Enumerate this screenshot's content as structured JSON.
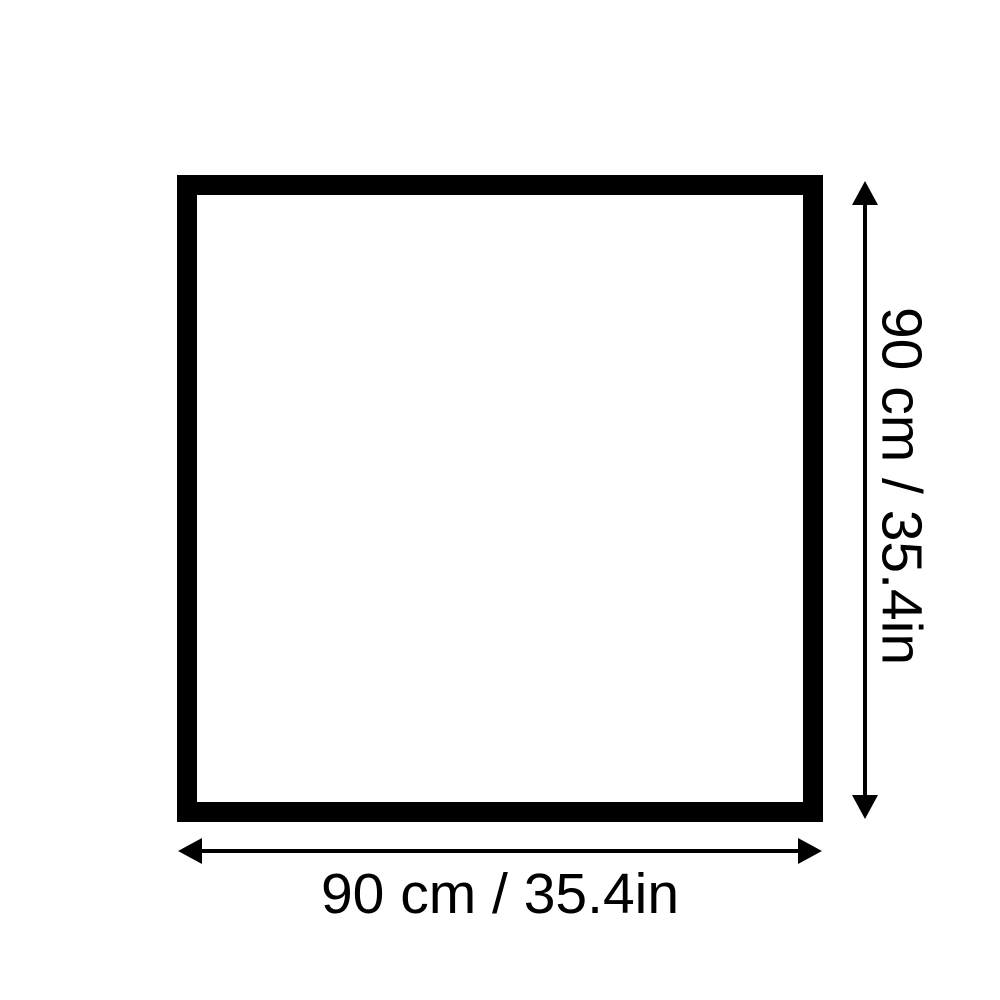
{
  "diagram": {
    "width_label": "90 cm / 35.4in",
    "height_label": "90 cm / 35.4in",
    "colors": {
      "outline": "#000000",
      "arrow": "#000000",
      "text": "#000000",
      "background": "#ffffff"
    }
  }
}
